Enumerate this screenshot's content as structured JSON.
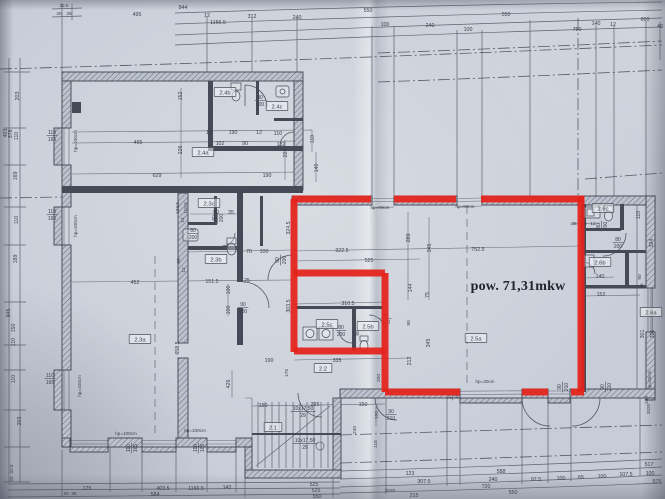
{
  "annotation": {
    "area_label": "pow. 71,31mkw"
  },
  "colors": {
    "paper": "#c7cdd7",
    "ink": "#3f4450",
    "red": "#e6231c"
  },
  "rooms": [
    {
      "id": "2.4b",
      "x": 225,
      "y": 93
    },
    {
      "id": "2.4c",
      "x": 277,
      "y": 107
    },
    {
      "id": "2.4a",
      "x": 203,
      "y": 153
    },
    {
      "id": "2.3c",
      "x": 209,
      "y": 204
    },
    {
      "id": "2.3b",
      "x": 216,
      "y": 260
    },
    {
      "id": "2.3a",
      "x": 140,
      "y": 340
    },
    {
      "id": "2.2",
      "x": 323,
      "y": 369
    },
    {
      "id": "2.1",
      "x": 273,
      "y": 428
    },
    {
      "id": "2.5c",
      "x": 327,
      "y": 325
    },
    {
      "id": "2.5b",
      "x": 368,
      "y": 327
    },
    {
      "id": "2.5a",
      "x": 476,
      "y": 339
    },
    {
      "id": "2.6c",
      "x": 603,
      "y": 209
    },
    {
      "id": "2.6b",
      "x": 600,
      "y": 263
    },
    {
      "id": "2.6a",
      "x": 651,
      "y": 313
    }
  ],
  "dimensions": [
    {
      "t": "844",
      "x": 183,
      "y": 7
    },
    {
      "t": "495",
      "x": 137,
      "y": 14
    },
    {
      "t": "12",
      "x": 207,
      "y": 15
    },
    {
      "t": "312",
      "x": 252,
      "y": 16
    },
    {
      "t": "240",
      "x": 297,
      "y": 17
    },
    {
      "t": "1166.5",
      "x": 218,
      "y": 22
    },
    {
      "t": "550",
      "x": 368,
      "y": 10
    },
    {
      "t": "100",
      "x": 385,
      "y": 24
    },
    {
      "t": "240",
      "x": 430,
      "y": 25
    },
    {
      "t": "550",
      "x": 506,
      "y": 14
    },
    {
      "t": "100",
      "x": 468,
      "y": 29
    },
    {
      "t": "140",
      "x": 596,
      "y": 23
    },
    {
      "t": "12",
      "x": 613,
      "y": 24
    },
    {
      "t": "600",
      "x": 645,
      "y": 19
    },
    {
      "t": "750",
      "x": 577,
      "y": 29
    },
    {
      "t": "40",
      "x": 660,
      "y": 26
    },
    {
      "t": "32.5",
      "x": 64,
      "y": 5,
      "s": 4.6
    },
    {
      "t": "20",
      "x": 59,
      "y": 13,
      "s": 4.6
    },
    {
      "t": "25",
      "x": 69,
      "y": 13,
      "s": 4.6
    },
    {
      "t": "403",
      "x": 5,
      "y": 133,
      "r": -90
    },
    {
      "t": "378",
      "x": 10,
      "y": 134,
      "r": -90
    },
    {
      "t": "110",
      "x": 16,
      "y": 136,
      "r": -90
    },
    {
      "t": "203",
      "x": 17,
      "y": 96,
      "r": -90
    },
    {
      "t": "169",
      "x": 15,
      "y": 176,
      "r": -90
    },
    {
      "t": "110",
      "x": 16,
      "y": 220,
      "r": -90
    },
    {
      "t": "189",
      "x": 15,
      "y": 259,
      "r": -90
    },
    {
      "t": "945",
      "x": 8,
      "y": 313,
      "r": -90
    },
    {
      "t": "150",
      "x": 13,
      "y": 328,
      "r": -90
    },
    {
      "t": "110",
      "x": 13,
      "y": 342,
      "r": -90
    },
    {
      "t": "110",
      "x": 13,
      "y": 379,
      "r": -90
    },
    {
      "t": "203",
      "x": 19,
      "y": 421,
      "r": -90
    },
    {
      "t": "32.5",
      "x": 11,
      "y": 469,
      "r": -90,
      "s": 4.6
    },
    {
      "t": "20",
      "x": 11,
      "y": 479,
      "r": -90,
      "s": 4.6
    },
    {
      "t": "hp=100cm",
      "x": 75,
      "y": 141,
      "r": -90,
      "s": 4.6
    },
    {
      "t": "hp=100cm",
      "x": 75,
      "y": 226,
      "r": -90,
      "s": 4.6
    },
    {
      "t": "hp=100cm",
      "x": 79,
      "y": 386,
      "r": -90,
      "s": 4.6
    },
    {
      "t": "hp=100cm",
      "x": 126,
      "y": 433,
      "s": 4.6
    },
    {
      "t": "hp=100cm",
      "x": 195,
      "y": 430,
      "s": 4.6
    },
    {
      "t": "hp=90cm",
      "x": 380,
      "y": 207,
      "s": 4.6
    },
    {
      "t": "hp=90cm",
      "x": 465,
      "y": 206,
      "s": 4.6
    },
    {
      "t": "hp=30cm",
      "x": 485,
      "y": 381,
      "s": 4.6
    },
    {
      "t": "hp=30cm",
      "x": 649,
      "y": 380,
      "r": -90,
      "s": 4.6
    },
    {
      "t": "152",
      "x": 180,
      "y": 96,
      "r": -90
    },
    {
      "t": "12",
      "x": 209,
      "y": 132
    },
    {
      "t": "190",
      "x": 233,
      "y": 132
    },
    {
      "t": "12",
      "x": 259,
      "y": 132
    },
    {
      "t": "110",
      "x": 278,
      "y": 133
    },
    {
      "t": "102",
      "x": 220,
      "y": 143
    },
    {
      "t": "90",
      "x": 245,
      "y": 143
    },
    {
      "t": "132",
      "x": 281,
      "y": 144
    },
    {
      "t": "495",
      "x": 138,
      "y": 142
    },
    {
      "t": "226",
      "x": 180,
      "y": 150,
      "r": -90
    },
    {
      "t": "226",
      "x": 285,
      "y": 153,
      "r": -90
    },
    {
      "t": "110",
      "x": 312,
      "y": 139,
      "r": -90
    },
    {
      "t": "140",
      "x": 316,
      "y": 168,
      "r": -90
    },
    {
      "t": "629",
      "x": 157,
      "y": 175
    },
    {
      "t": "190",
      "x": 267,
      "y": 175
    },
    {
      "t": "90",
      "x": 216,
      "y": 212
    },
    {
      "t": "35",
      "x": 231,
      "y": 212
    },
    {
      "t": "133.5",
      "x": 177,
      "y": 208,
      "r": -90,
      "s": 4.8
    },
    {
      "t": "110.5",
      "x": 185,
      "y": 208,
      "r": -90,
      "s": 4.8
    },
    {
      "t": "12",
      "x": 182,
      "y": 220,
      "r": -90,
      "s": 4.8
    },
    {
      "t": "324.5",
      "x": 288,
      "y": 228,
      "r": -90
    },
    {
      "t": "70",
      "x": 249,
      "y": 251
    },
    {
      "t": "100",
      "x": 264,
      "y": 251
    },
    {
      "t": "89",
      "x": 178,
      "y": 261,
      "r": -90,
      "s": 4.8
    },
    {
      "t": "12",
      "x": 183,
      "y": 270,
      "r": -90,
      "s": 4.8
    },
    {
      "t": "151.5",
      "x": 212,
      "y": 281
    },
    {
      "t": "25",
      "x": 247,
      "y": 280
    },
    {
      "t": "100",
      "x": 228,
      "y": 290,
      "r": -90
    },
    {
      "t": "100",
      "x": 228,
      "y": 310,
      "r": -90
    },
    {
      "t": "303.5",
      "x": 288,
      "y": 306,
      "r": -90
    },
    {
      "t": "452",
      "x": 135,
      "y": 282
    },
    {
      "t": "658.5",
      "x": 177,
      "y": 348,
      "r": -90
    },
    {
      "t": "190",
      "x": 269,
      "y": 360
    },
    {
      "t": "426",
      "x": 228,
      "y": 384,
      "r": -90
    },
    {
      "t": "322.5",
      "x": 342,
      "y": 250
    },
    {
      "t": "525",
      "x": 369,
      "y": 260
    },
    {
      "t": "289",
      "x": 408,
      "y": 238,
      "r": -90
    },
    {
      "t": "345",
      "x": 429,
      "y": 248,
      "r": -90
    },
    {
      "t": "752.5",
      "x": 478,
      "y": 249
    },
    {
      "t": "75",
      "x": 427,
      "y": 295,
      "r": -90
    },
    {
      "t": "144",
      "x": 410,
      "y": 288,
      "r": -90
    },
    {
      "t": "310.5",
      "x": 348,
      "y": 303
    },
    {
      "t": "22",
      "x": 353,
      "y": 317,
      "r": -90,
      "s": 4.8
    },
    {
      "t": "90",
      "x": 357,
      "y": 333,
      "r": -90,
      "s": 4.8
    },
    {
      "t": "90",
      "x": 408,
      "y": 323,
      "r": -90,
      "s": 4.8
    },
    {
      "t": "335",
      "x": 337,
      "y": 360
    },
    {
      "t": "175",
      "x": 286,
      "y": 373,
      "r": -90,
      "s": 4.8
    },
    {
      "t": "200",
      "x": 378,
      "y": 378,
      "r": -90,
      "s": 4.8
    },
    {
      "t": "212",
      "x": 409,
      "y": 361,
      "r": -90
    },
    {
      "t": "345",
      "x": 428,
      "y": 343,
      "r": -90
    },
    {
      "t": "35",
      "x": 574,
      "y": 223,
      "s": 4.8
    },
    {
      "t": "80",
      "x": 584,
      "y": 223,
      "s": 4.8
    },
    {
      "t": "12",
      "x": 593,
      "y": 223,
      "s": 4.8
    },
    {
      "t": "110",
      "x": 638,
      "y": 215,
      "r": -90
    },
    {
      "t": "324",
      "x": 651,
      "y": 243,
      "r": -90
    },
    {
      "t": "90",
      "x": 639,
      "y": 277,
      "r": -90,
      "s": 4.8
    },
    {
      "t": "25",
      "x": 641,
      "y": 286,
      "r": -90,
      "s": 4.8
    },
    {
      "t": "140",
      "x": 600,
      "y": 276
    },
    {
      "t": "152",
      "x": 601,
      "y": 294
    },
    {
      "t": "301",
      "x": 642,
      "y": 334,
      "r": -90
    },
    {
      "t": "391",
      "x": 652,
      "y": 334,
      "r": -90
    },
    {
      "t": "150",
      "x": 263,
      "y": 405
    },
    {
      "t": "225",
      "x": 315,
      "y": 404
    },
    {
      "t": "150",
      "x": 363,
      "y": 404
    },
    {
      "t": "100",
      "x": 376,
      "y": 415,
      "r": -90,
      "s": 4.8
    },
    {
      "t": "240",
      "x": 354,
      "y": 430,
      "r": -90,
      "s": 4.8
    },
    {
      "t": "115",
      "x": 375,
      "y": 444,
      "r": -90,
      "s": 4.8
    },
    {
      "t": "100",
      "x": 646,
      "y": 400,
      "r": -90,
      "s": 4.8
    },
    {
      "t": "123",
      "x": 410,
      "y": 473
    },
    {
      "t": "307.5",
      "x": 424,
      "y": 481
    },
    {
      "t": "215",
      "x": 414,
      "y": 495
    },
    {
      "t": "588",
      "x": 501,
      "y": 471
    },
    {
      "t": "240",
      "x": 493,
      "y": 479
    },
    {
      "t": "720",
      "x": 486,
      "y": 486
    },
    {
      "t": "550",
      "x": 513,
      "y": 492
    },
    {
      "t": "97.5",
      "x": 536,
      "y": 479
    },
    {
      "t": "100",
      "x": 561,
      "y": 478
    },
    {
      "t": "65",
      "x": 581,
      "y": 477
    },
    {
      "t": "100",
      "x": 602,
      "y": 476
    },
    {
      "t": "107.5",
      "x": 626,
      "y": 474
    },
    {
      "t": "100",
      "x": 650,
      "y": 473
    },
    {
      "t": "517",
      "x": 649,
      "y": 464
    },
    {
      "t": "575",
      "x": 657,
      "y": 481
    },
    {
      "t": "175",
      "x": 87,
      "y": 488
    },
    {
      "t": "403.5",
      "x": 163,
      "y": 488
    },
    {
      "t": "1166.5",
      "x": 196,
      "y": 488
    },
    {
      "t": "142",
      "x": 227,
      "y": 487
    },
    {
      "t": "584",
      "x": 155,
      "y": 494
    },
    {
      "t": "20",
      "x": 66,
      "y": 493,
      "s": 4.6
    },
    {
      "t": "25",
      "x": 74,
      "y": 493,
      "s": 4.6
    },
    {
      "t": "525",
      "x": 314,
      "y": 484
    },
    {
      "t": "525",
      "x": 316,
      "y": 490
    },
    {
      "t": "550",
      "x": 317,
      "y": 496
    },
    {
      "t": "2020",
      "x": 390,
      "y": 490,
      "s": 4.6
    },
    {
      "t": "2020",
      "x": 648,
      "y": 409,
      "r": -90,
      "s": 4.6
    }
  ],
  "fractions": [
    {
      "a": "80",
      "b": "200",
      "x": 260,
      "y": 95
    },
    {
      "a": "80",
      "b": "200",
      "x": 212,
      "y": 218,
      "r": -90
    },
    {
      "a": "80",
      "b": "200",
      "x": 193,
      "y": 228
    },
    {
      "a": "90",
      "b": "200",
      "x": 243,
      "y": 302
    },
    {
      "a": "90",
      "b": "200",
      "x": 275,
      "y": 260,
      "r": -90
    },
    {
      "a": "80",
      "b": "200",
      "x": 341,
      "y": 325
    },
    {
      "a": "80",
      "b": "200",
      "x": 386,
      "y": 313
    },
    {
      "a": "80",
      "b": "200",
      "x": 596,
      "y": 226,
      "r": -90
    },
    {
      "a": "80",
      "b": "200",
      "x": 618,
      "y": 237
    },
    {
      "a": "90",
      "b": "210",
      "x": 391,
      "y": 409
    },
    {
      "a": "90",
      "b": "210",
      "x": 557,
      "y": 387,
      "r": -90
    },
    {
      "a": "90",
      "b": "210",
      "x": 600,
      "y": 387,
      "r": -90
    },
    {
      "a": "240",
      "b": "160",
      "x": 447,
      "y": 395,
      "r": -90
    },
    {
      "a": "110",
      "b": "165",
      "x": 52,
      "y": 130
    },
    {
      "a": "110",
      "b": "165",
      "x": 52,
      "y": 209
    },
    {
      "a": "110",
      "b": "165",
      "x": 50,
      "y": 373
    },
    {
      "a": "110",
      "b": "165",
      "x": 126,
      "y": 448,
      "r": -90
    },
    {
      "a": "110",
      "b": "165",
      "x": 193,
      "y": 448,
      "r": -90
    },
    {
      "a": "10x17,50",
      "b": "29",
      "x": 303,
      "y": 406
    },
    {
      "a": "10x17,50",
      "b": "29",
      "x": 305,
      "y": 438
    }
  ],
  "red_overlay": {
    "stroke_width": 7,
    "segments": [
      {
        "x1": 292,
        "y1": 199,
        "x2": 371,
        "y2": 199
      },
      {
        "x1": 394,
        "y1": 199,
        "x2": 456,
        "y2": 199
      },
      {
        "x1": 481,
        "y1": 199,
        "x2": 584,
        "y2": 199
      },
      {
        "x1": 581,
        "y1": 196,
        "x2": 581,
        "y2": 392
      },
      {
        "x1": 571,
        "y1": 392,
        "x2": 584,
        "y2": 392
      },
      {
        "x1": 522,
        "y1": 392,
        "x2": 548,
        "y2": 392
      },
      {
        "x1": 385,
        "y1": 392,
        "x2": 460,
        "y2": 392
      },
      {
        "x1": 385,
        "y1": 273,
        "x2": 385,
        "y2": 392
      },
      {
        "x1": 294,
        "y1": 273,
        "x2": 385,
        "y2": 273
      },
      {
        "x1": 294,
        "y1": 199,
        "x2": 294,
        "y2": 352
      },
      {
        "x1": 294,
        "y1": 351,
        "x2": 385,
        "y2": 351
      }
    ]
  }
}
